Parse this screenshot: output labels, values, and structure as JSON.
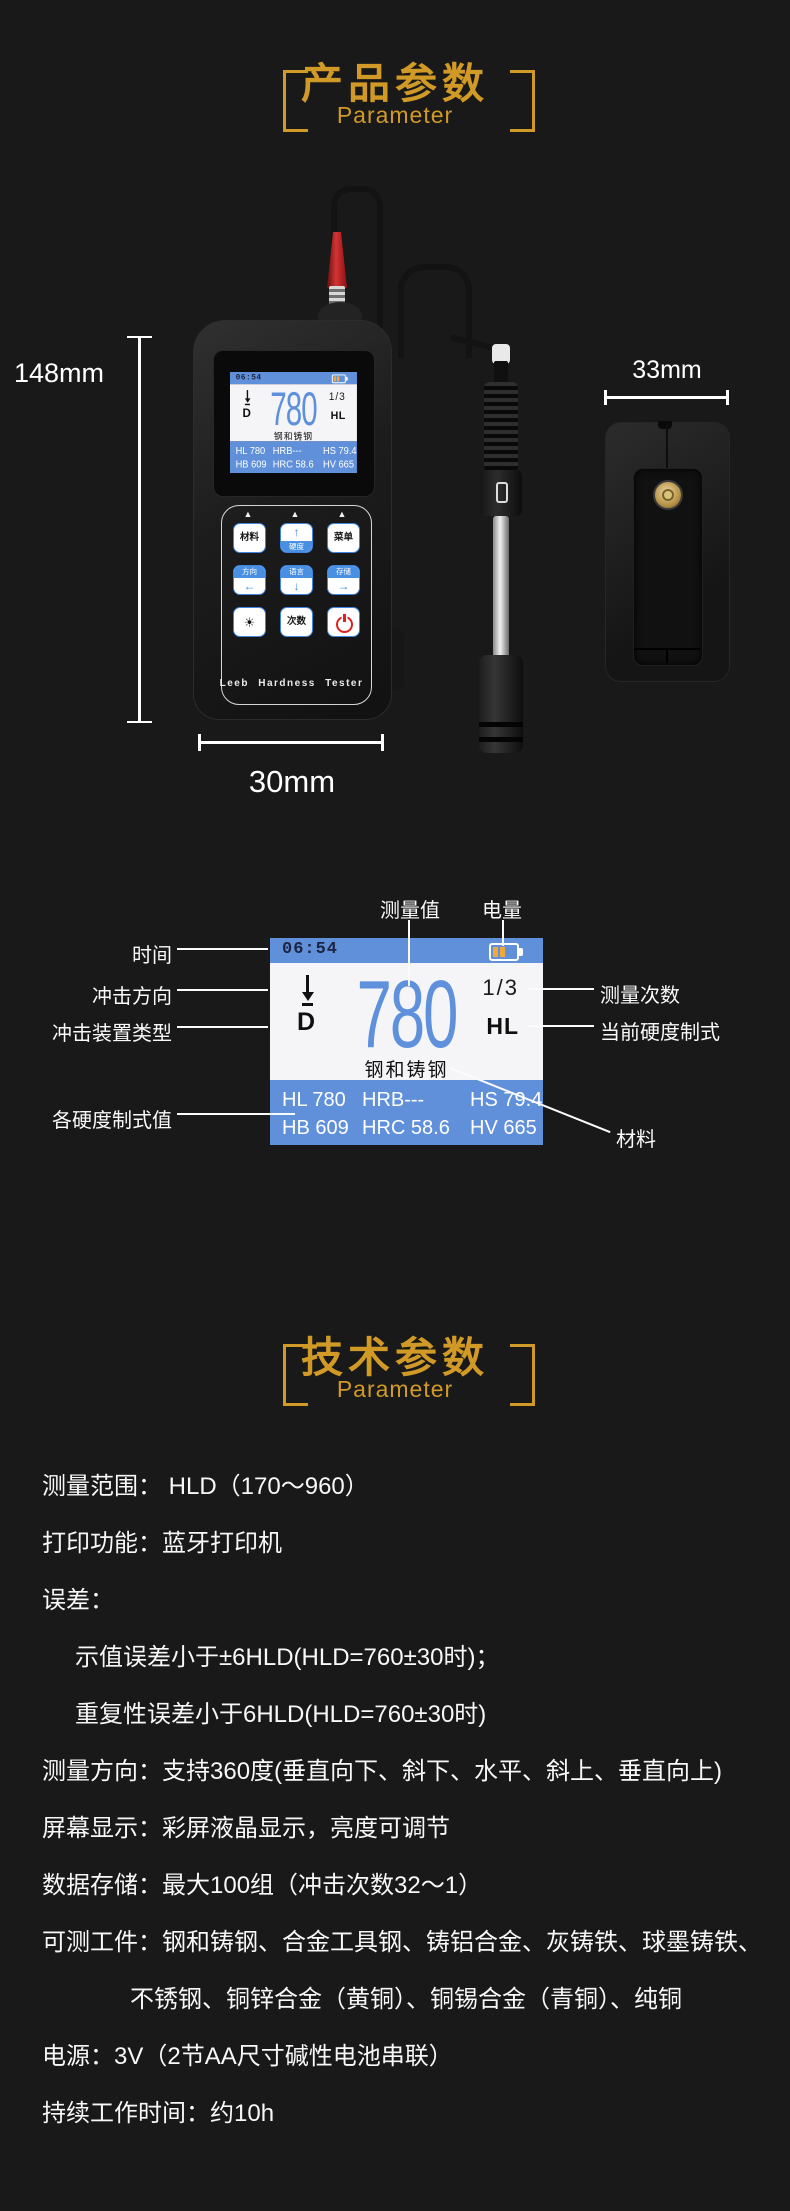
{
  "product_section": {
    "title": "产品参数",
    "subtitle": "Parameter",
    "height_label": "148mm",
    "width_label": "30mm",
    "probe_width_label": "33mm",
    "brand": "Leeb Hardness Tester",
    "keypad": {
      "r1c1": "材料",
      "r1c2_arrow": "↑",
      "r1c2": "硬度",
      "r1c3": "菜单",
      "r2c1": "方向",
      "r2c1_arrow": "←",
      "r2c2": "语言",
      "r2c2_arrow": "↓",
      "r2c3": "存储",
      "r2c3_arrow": "→",
      "r3c2": "次数",
      "triangle": "▲",
      "brightness_icon": "☀"
    }
  },
  "screen": {
    "time": "06:54",
    "measure_value": "780",
    "count": "1/3",
    "scale": "HL",
    "device_type": "D",
    "material": "钢和铸钢",
    "values_row1": [
      "HL 780",
      "HRB---",
      "HS 79.4"
    ],
    "values_row2": [
      "HB 609",
      "HRC 58.6",
      "HV 665"
    ]
  },
  "diagram_labels": {
    "measure_value": "测量值",
    "battery": "电量",
    "time": "时间",
    "impact_direction": "冲击方向",
    "impact_device_type": "冲击装置类型",
    "scale_values": "各硬度制式值",
    "measure_count": "测量次数",
    "current_scale": "当前硬度制式",
    "material": "材料"
  },
  "tech_section": {
    "title": "技术参数",
    "subtitle": "Parameter",
    "specs": [
      "测量范围： HLD（170～960）",
      "打印功能：蓝牙打印机",
      "误差：",
      "示值误差小于±6HLD(HLD=760±30时)；",
      "重复性误差小于6HLD(HLD=760±30时)",
      "测量方向：支持360度(垂直向下、斜下、水平、斜上、垂直向上)",
      "屏幕显示：彩屏液晶显示，亮度可调节",
      "数据存储：最大100组（冲击次数32～1）",
      "可测工件：钢和铸钢、合金工具钢、铸铝合金、灰铸铁、球墨铸铁、",
      "不锈钢、铜锌合金（黄铜）、铜锡合金（青铜）、纯铜",
      "电源：3V（2节AA尺寸碱性电池串联）",
      "持续工作时间：约10h"
    ]
  },
  "colors": {
    "accent": "#D19A27",
    "screen_blue": "#6190DB",
    "value_blue": "#5E90DB",
    "battery_amber": "#F2A93B",
    "button_blue": "#4A90E2",
    "power_red": "#E02020"
  }
}
